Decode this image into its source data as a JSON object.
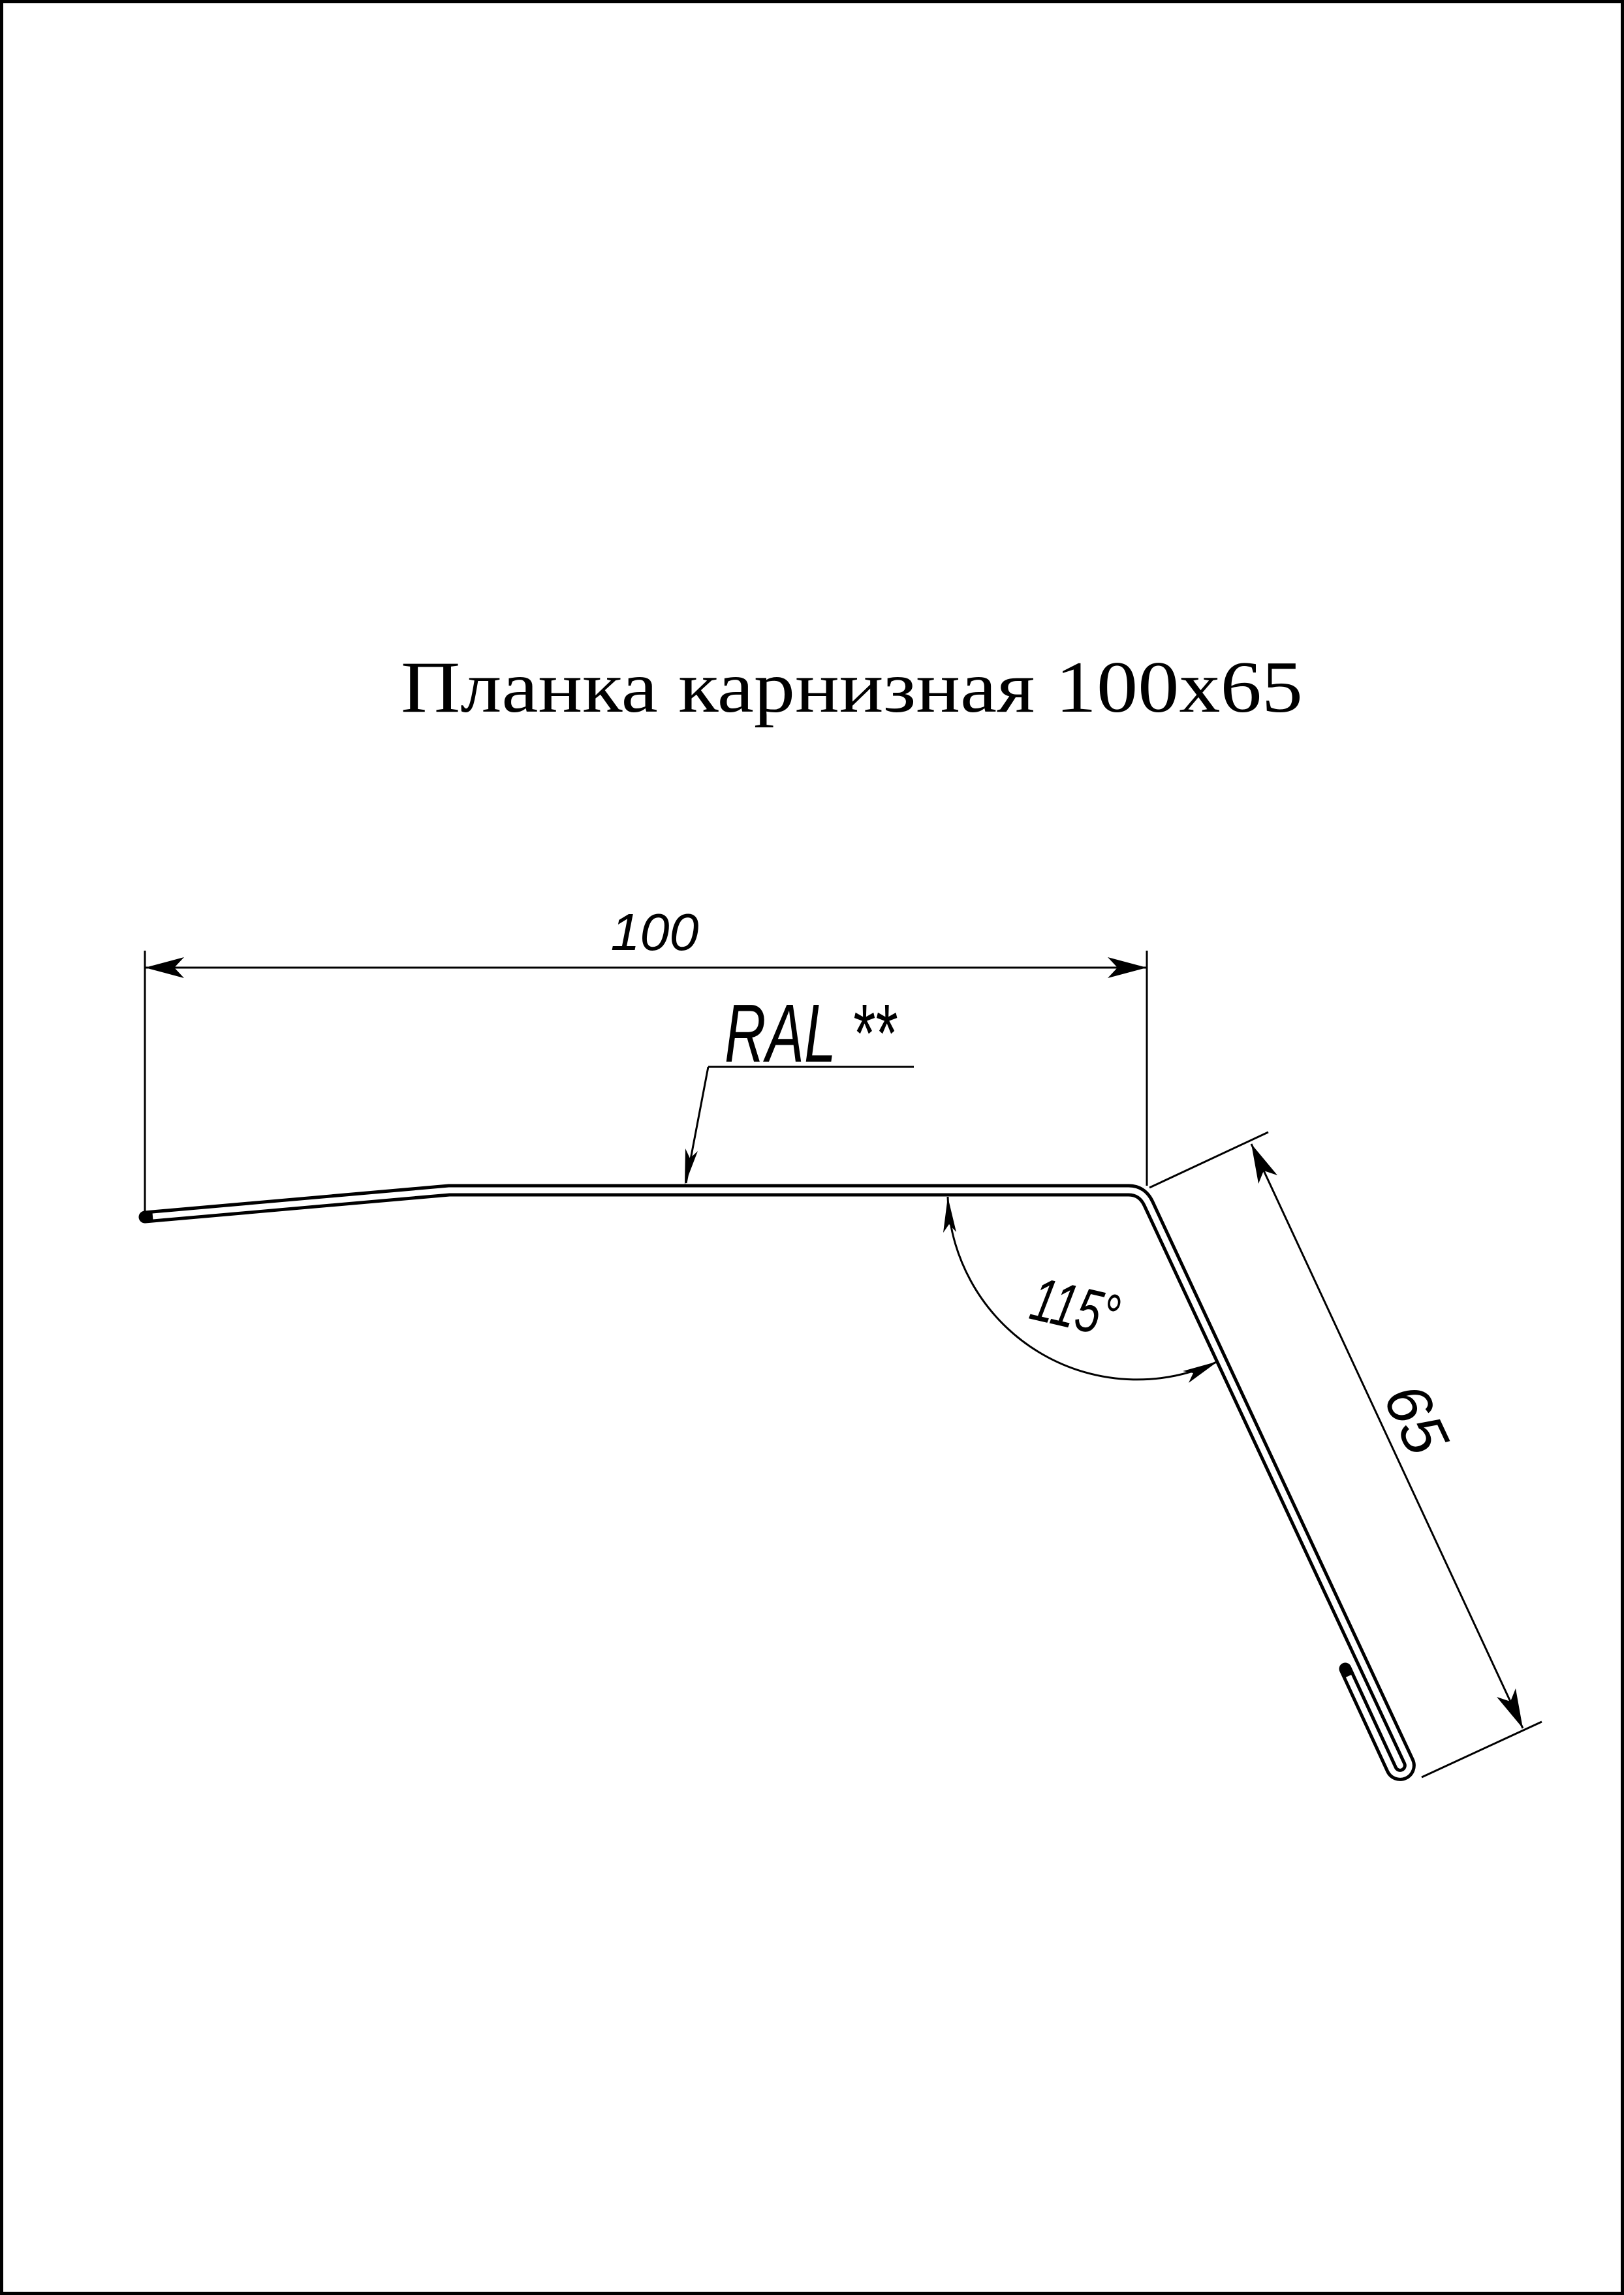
{
  "page": {
    "bg_color": "#ffffff",
    "ink_color": "#000000"
  },
  "title": "Планка карнизная 100х65",
  "annotations": {
    "width_dim": "100",
    "height_dim": "65",
    "angle_dim": "115°",
    "coating": "RAL **"
  }
}
